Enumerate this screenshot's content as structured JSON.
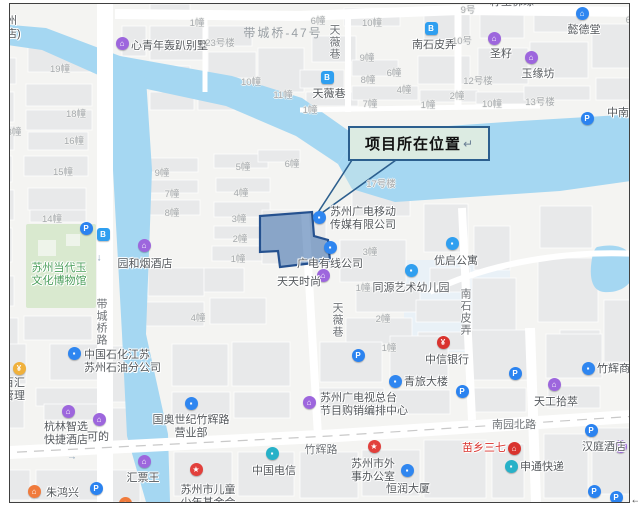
{
  "callout": {
    "text": "项目所在位置",
    "return_mark": "↵"
  },
  "page": {
    "return_mark": "←"
  },
  "colors": {
    "water": "#a5d7f2",
    "land": "#f4f4f2",
    "building": "#e8e9ea",
    "road": "#ffffff",
    "park": "#d9e9cf",
    "site_fill": "#5b84b8",
    "site_border": "#25518f",
    "callout_fill": "#dcebe2",
    "callout_border": "#2c5f8e",
    "poi_blue": "#2f86f0",
    "poi_lightblue": "#2f9ff0",
    "poi_purple": "#9d66dd",
    "poi_red": "#e2403c",
    "poi_orange": "#f07b3c",
    "poi_teal": "#27b1c8",
    "poi_yellow": "#f0b13c"
  },
  "map": {
    "pois": [
      {
        "lines": [
          "心青年轰趴别墅"
        ],
        "lx": 131,
        "ly": 40,
        "anchor": "l",
        "icon": {
          "x": 122,
          "y": 43,
          "c": "#9d66dd",
          "g": "⌂"
        }
      },
      {
        "lines": [
          "南石皮弄"
        ],
        "lx": 434,
        "ly": 39,
        "anchor": "c",
        "icon": {
          "x": 431,
          "y": 28,
          "c": "#2f9ff0",
          "g": "B",
          "sq": true
        }
      },
      {
        "lines": [
          "圣籽"
        ],
        "lx": 501,
        "ly": 48,
        "anchor": "c",
        "icon": {
          "x": 494,
          "y": 38,
          "c": "#9d66dd",
          "g": "⌂"
        }
      },
      {
        "lines": [
          "玉缘坊"
        ],
        "lx": 538,
        "ly": 68,
        "anchor": "c",
        "icon": {
          "x": 531,
          "y": 57,
          "c": "#9d66dd",
          "g": "⌂"
        }
      },
      {
        "lines": [
          "懿德堂"
        ],
        "lx": 584,
        "ly": 24,
        "anchor": "c",
        "icon": {
          "x": 582,
          "y": 13,
          "c": "#2f86f0",
          "g": "⌂"
        }
      },
      {
        "lines": [
          "天薇巷"
        ],
        "lx": 329,
        "ly": 88,
        "anchor": "c",
        "icon": {
          "x": 327,
          "y": 77,
          "c": "#2f9ff0",
          "g": "B",
          "sq": true
        }
      },
      {
        "lines": [
          "中南钻"
        ],
        "lx": 607,
        "ly": 107,
        "anchor": "l",
        "icon": {
          "x": 636,
          "y": 100,
          "c": "#9d66dd",
          "g": "⌂"
        }
      },
      {
        "lines": [
          "刘"
        ],
        "lx": 630,
        "ly": 81,
        "anchor": "l"
      },
      {
        "lines": [
          "籽玉佛缘"
        ],
        "lx": 512,
        "ly": -4,
        "anchor": "c"
      },
      {
        "lines": [
          "苏州",
          "酒店)"
        ],
        "lx": -5,
        "ly": 15,
        "anchor": "l"
      },
      {
        "lines": [
          "苏州广电移动",
          "传媒有限公司"
        ],
        "lx": 330,
        "ly": 206,
        "anchor": "l",
        "icon": {
          "x": 319,
          "y": 217,
          "c": "#2f86f0",
          "g": "▪"
        }
      },
      {
        "lines": [
          "广电有线公司"
        ],
        "lx": 330,
        "ly": 258,
        "anchor": "c",
        "icon": {
          "x": 330,
          "y": 247,
          "c": "#2f86f0",
          "g": "▪"
        }
      },
      {
        "lines": [
          "天天时尚"
        ],
        "lx": 299,
        "ly": 276,
        "anchor": "c",
        "icon": {
          "x": 323,
          "y": 275,
          "c": "#9d66dd",
          "g": "⌂"
        }
      },
      {
        "lines": [
          "同源艺术幼儿园"
        ],
        "lx": 411,
        "ly": 282,
        "anchor": "c",
        "icon": {
          "x": 411,
          "y": 270,
          "c": "#2f9ff0",
          "g": "▪"
        }
      },
      {
        "lines": [
          "优启公寓"
        ],
        "lx": 456,
        "ly": 255,
        "anchor": "c",
        "icon": {
          "x": 452,
          "y": 243,
          "c": "#2f9ff0",
          "g": "▪"
        }
      },
      {
        "lines": [
          "园和烟酒店"
        ],
        "lx": 145,
        "ly": 258,
        "anchor": "c",
        "icon": {
          "x": 144,
          "y": 245,
          "c": "#9d66dd",
          "g": "⌂"
        }
      },
      {
        "lines": [
          "中国石化江苏",
          "苏州石油分公司"
        ],
        "lx": 84,
        "ly": 349,
        "anchor": "l",
        "icon": {
          "x": 74,
          "y": 353,
          "c": "#2f86f0",
          "g": "▪"
        }
      },
      {
        "lines": [
          "信百汇",
          "产管理"
        ],
        "lx": -8,
        "ly": 377,
        "anchor": "l",
        "icon": {
          "x": 19,
          "y": 368,
          "c": "#f0b13c",
          "g": "¥"
        }
      },
      {
        "lines": [
          "杭林智选",
          "快捷酒店"
        ],
        "lx": 66,
        "ly": 421,
        "anchor": "c",
        "icon": {
          "x": 68,
          "y": 411,
          "c": "#9d66dd",
          "g": "⌂"
        }
      },
      {
        "lines": [
          "可的"
        ],
        "lx": 98,
        "ly": 431,
        "anchor": "c",
        "icon": {
          "x": 99,
          "y": 419,
          "c": "#9d66dd",
          "g": "⌂"
        }
      },
      {
        "lines": [
          "国奥世纪竹辉路",
          "营业部"
        ],
        "lx": 191,
        "ly": 414,
        "anchor": "c",
        "icon": {
          "x": 191,
          "y": 403,
          "c": "#2f86f0",
          "g": "▪"
        }
      },
      {
        "lines": [
          "汇票王"
        ],
        "lx": 143,
        "ly": 472,
        "anchor": "c",
        "icon": {
          "x": 144,
          "y": 461,
          "c": "#9d66dd",
          "g": "⌂"
        }
      },
      {
        "lines": [
          "朱鸿兴"
        ],
        "lx": 46,
        "ly": 487,
        "anchor": "l",
        "icon": {
          "x": 34,
          "y": 491,
          "c": "#f07b3c",
          "g": "⌂"
        }
      },
      {
        "lines": [
          "苏州市儿童",
          "少年基金会"
        ],
        "lx": 208,
        "ly": 484,
        "anchor": "c",
        "icon": {
          "x": 196,
          "y": 469,
          "c": "#e2403c",
          "g": "★"
        }
      },
      {
        "lines": [
          "中国电信"
        ],
        "lx": 274,
        "ly": 465,
        "anchor": "c",
        "icon": {
          "x": 272,
          "y": 453,
          "c": "#27b1c8",
          "g": "▪"
        }
      },
      {
        "lines": [
          "中信银行"
        ],
        "lx": 447,
        "ly": 354,
        "anchor": "c",
        "icon": {
          "x": 443,
          "y": 342,
          "c": "#d9332e",
          "g": "¥"
        }
      },
      {
        "lines": [
          "青旅大楼"
        ],
        "lx": 404,
        "ly": 376,
        "anchor": "l",
        "icon": {
          "x": 395,
          "y": 381,
          "c": "#2f86f0",
          "g": "▪"
        }
      },
      {
        "lines": [
          "苏州广电视总台",
          "节目购销编排中心"
        ],
        "lx": 320,
        "ly": 392,
        "anchor": "l",
        "icon": {
          "x": 309,
          "y": 402,
          "c": "#9d66dd",
          "g": "⌂"
        }
      },
      {
        "lines": [
          "天工拾萃"
        ],
        "lx": 556,
        "ly": 396,
        "anchor": "c",
        "icon": {
          "x": 554,
          "y": 384,
          "c": "#9d66dd",
          "g": "⌂"
        }
      },
      {
        "lines": [
          "竹辉商厦"
        ],
        "lx": 597,
        "ly": 363,
        "anchor": "l",
        "icon": {
          "x": 588,
          "y": 368,
          "c": "#2f86f0",
          "g": "▪"
        }
      },
      {
        "lines": [
          "苏州市外",
          "事办公室"
        ],
        "lx": 373,
        "ly": 458,
        "anchor": "c",
        "icon": {
          "x": 374,
          "y": 446,
          "c": "#e2403c",
          "g": "★"
        }
      },
      {
        "lines": [
          "恒润大厦"
        ],
        "lx": 408,
        "ly": 483,
        "anchor": "c",
        "icon": {
          "x": 407,
          "y": 470,
          "c": "#2f86f0",
          "g": "▪"
        }
      },
      {
        "lines": [
          "苗乡三七"
        ],
        "lx": 484,
        "ly": 442,
        "anchor": "c",
        "tcolor": "#d9332e",
        "icon": {
          "x": 514,
          "y": 448,
          "c": "#d9332e",
          "g": "⌂"
        }
      },
      {
        "lines": [
          "申通快递"
        ],
        "lx": 520,
        "ly": 461,
        "anchor": "l",
        "icon": {
          "x": 511,
          "y": 466,
          "c": "#27b1c8",
          "g": "▪"
        }
      },
      {
        "lines": [
          "汉庭酒店"
        ],
        "lx": 582,
        "ly": 441,
        "anchor": "l",
        "icon": {
          "x": 620,
          "y": 446,
          "c": "#9d66dd",
          "g": "⌂"
        }
      },
      {
        "lines": [
          "苏州当代玉",
          "文化博物馆"
        ],
        "lx": 59,
        "ly": 262,
        "anchor": "c",
        "tcolor": "#4c9f5c"
      }
    ],
    "building_labels": [
      {
        "t": "19幢",
        "x": 60,
        "y": 68
      },
      {
        "t": "18幢",
        "x": 76,
        "y": 113
      },
      {
        "t": "16幢",
        "x": 74,
        "y": 140
      },
      {
        "t": "15幢",
        "x": 63,
        "y": 171
      },
      {
        "t": "3幢",
        "x": 14,
        "y": 131
      },
      {
        "t": "14幢",
        "x": 52,
        "y": 218
      },
      {
        "t": "1幢",
        "x": 197,
        "y": 22
      },
      {
        "t": "23号楼",
        "x": 220,
        "y": 42
      },
      {
        "t": "10幢",
        "x": 251,
        "y": 81
      },
      {
        "t": "11幢",
        "x": 283,
        "y": 94
      },
      {
        "t": "1幢",
        "x": 310,
        "y": 109
      },
      {
        "t": "6幢",
        "x": 318,
        "y": 20
      },
      {
        "t": "10幢",
        "x": 372,
        "y": 22
      },
      {
        "t": "9幢",
        "x": 367,
        "y": 57
      },
      {
        "t": "8幢",
        "x": 368,
        "y": 79
      },
      {
        "t": "6幢",
        "x": 394,
        "y": 72
      },
      {
        "t": "4幢",
        "x": 404,
        "y": 89
      },
      {
        "t": "7幢",
        "x": 370,
        "y": 103
      },
      {
        "t": "1幢",
        "x": 428,
        "y": 104
      },
      {
        "t": "2幢",
        "x": 457,
        "y": 95
      },
      {
        "t": "12号楼",
        "x": 478,
        "y": 80
      },
      {
        "t": "10幢",
        "x": 492,
        "y": 103
      },
      {
        "t": "13号楼",
        "x": 540,
        "y": 101
      },
      {
        "t": "9号",
        "x": 468,
        "y": 9
      },
      {
        "t": "10号",
        "x": 462,
        "y": 40
      },
      {
        "t": "6幢",
        "x": 633,
        "y": 19
      },
      {
        "t": "9幢",
        "x": 162,
        "y": 172
      },
      {
        "t": "7幢",
        "x": 172,
        "y": 193
      },
      {
        "t": "8幢",
        "x": 172,
        "y": 212
      },
      {
        "t": "5幢",
        "x": 243,
        "y": 166
      },
      {
        "t": "6幢",
        "x": 292,
        "y": 163
      },
      {
        "t": "4幢",
        "x": 241,
        "y": 192
      },
      {
        "t": "3幢",
        "x": 239,
        "y": 218
      },
      {
        "t": "2幢",
        "x": 240,
        "y": 238
      },
      {
        "t": "1幢",
        "x": 238,
        "y": 258
      },
      {
        "t": "4幢",
        "x": 198,
        "y": 317
      },
      {
        "t": "17号楼",
        "x": 381,
        "y": 183
      },
      {
        "t": "3幢",
        "x": 370,
        "y": 251
      },
      {
        "t": "1幢",
        "x": 363,
        "y": 287
      },
      {
        "t": "2幢",
        "x": 383,
        "y": 318
      },
      {
        "t": "1幢",
        "x": 389,
        "y": 347
      }
    ],
    "road_labels_vertical": [
      {
        "t": "带城桥路",
        "x": 101,
        "y": 298
      },
      {
        "t": "天薇巷",
        "x": 334,
        "y": 24
      },
      {
        "t": "天薇巷",
        "x": 337,
        "y": 302
      },
      {
        "t": "南石皮弄",
        "x": 465,
        "y": 288
      }
    ],
    "road_labels_horizontal": [
      {
        "t": "南园北路",
        "x": 514,
        "y": 416
      },
      {
        "t": "竹辉路",
        "x": 321,
        "y": 441
      }
    ],
    "area_labels": [
      {
        "t": "带城桥-47号",
        "x": 283,
        "y": 24
      }
    ],
    "parking_icons": [
      [
        86,
        228
      ],
      [
        587,
        118
      ],
      [
        358,
        355
      ],
      [
        462,
        391
      ],
      [
        515,
        373
      ],
      [
        591,
        430
      ],
      [
        96,
        488
      ],
      [
        594,
        491
      ],
      [
        616,
        497
      ]
    ],
    "bus_icons": [
      [
        103,
        234
      ]
    ],
    "extra_icons": [
      {
        "x": 125,
        "y": 503,
        "c": "#f07b3c",
        "g": "⌂"
      }
    ],
    "arrows": [
      {
        "t": "↓",
        "x": 99,
        "y": 258
      },
      {
        "t": "→",
        "x": 72,
        "y": 457
      }
    ]
  }
}
